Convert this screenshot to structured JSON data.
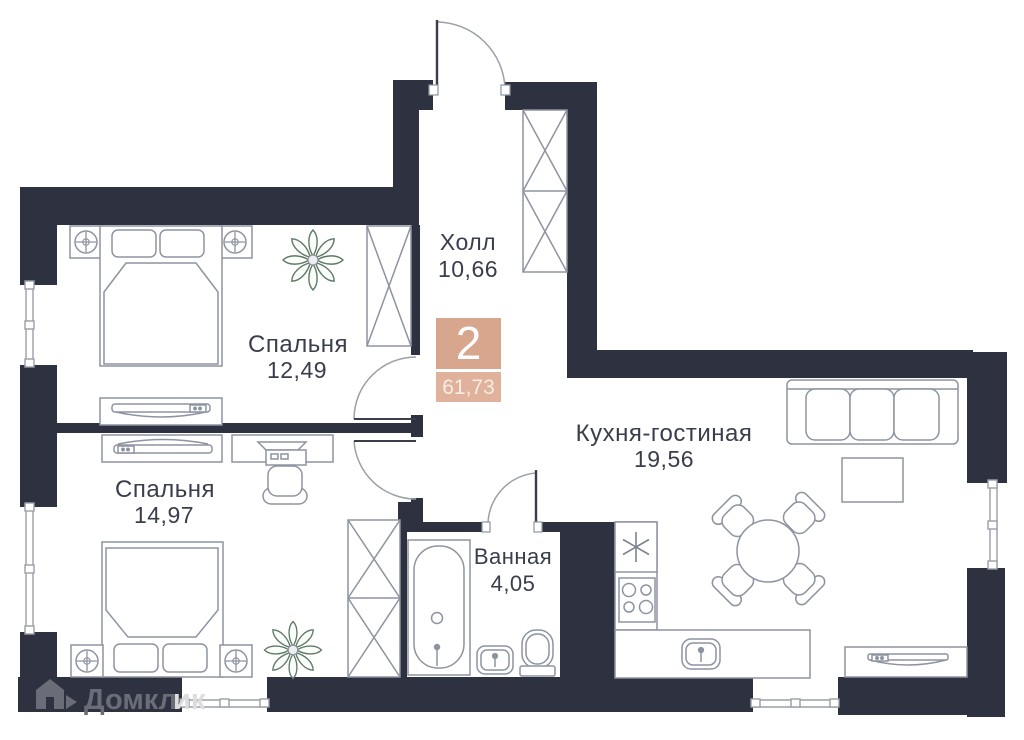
{
  "plan": {
    "type": "apartment-floor-plan",
    "badge": {
      "rooms_count": "2",
      "total_area": "61,73"
    },
    "rooms": [
      {
        "name": "Холл",
        "area": "10,66"
      },
      {
        "name": "Спальня",
        "area": "12,49"
      },
      {
        "name": "Спальня",
        "area": "14,97"
      },
      {
        "name": "Кухня-гостиная",
        "area": "19,56"
      },
      {
        "name": "Ванная",
        "area": "4,05"
      }
    ],
    "colors": {
      "walls": "#2e3140",
      "badge_top": "#d8a68c",
      "badge_bottom": "#e0b29c",
      "label_text": "#3a3d4c",
      "furniture_lines": "#8d93a0",
      "plant_green": "#5d7a65"
    }
  },
  "watermark": {
    "icon": "domclick-house-icon",
    "brand_dark": "Домкл",
    "brand_light": "ик"
  }
}
